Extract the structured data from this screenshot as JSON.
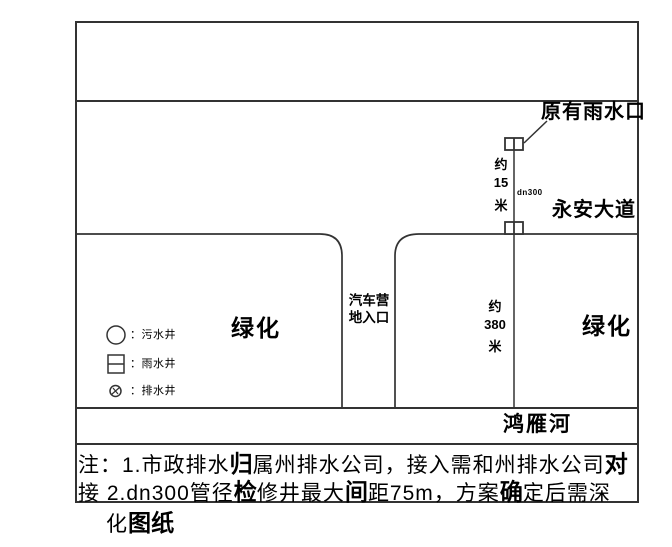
{
  "drawing": {
    "title_labels": {
      "existing_rain_inlet": "原有雨水口",
      "road_name": "永安大道",
      "river_name": "鸿雁河",
      "green_area_left": "绿化",
      "green_area_right": "绿化",
      "entrance_line1": "汽车营",
      "entrance_line2": "地入口",
      "pipe_label": "dn300"
    },
    "dimensions": {
      "dist15": {
        "prefix": "约",
        "value": "15",
        "unit": "米"
      },
      "dist380": {
        "prefix": "约",
        "value": "380",
        "unit": "米"
      }
    },
    "legend": {
      "items": [
        {
          "symbol": "circle",
          "label": "：污水井"
        },
        {
          "symbol": "square",
          "label": "：雨水井"
        },
        {
          "symbol": "hatched-circle",
          "label": "：排水井"
        }
      ]
    },
    "notes": {
      "line1": [
        {
          "t": "注：1.市政排水"
        },
        {
          "t": "归",
          "b": true
        },
        {
          "t": "属州排水公司，接入需和州排水公司"
        },
        {
          "t": "对",
          "b": true
        }
      ],
      "line2": [
        {
          "t": "接 2.dn300管径"
        },
        {
          "t": "检",
          "b": true
        },
        {
          "t": "修井最大"
        },
        {
          "t": "间",
          "b": true
        },
        {
          "t": "距75m，方案"
        },
        {
          "t": "确",
          "b": true
        },
        {
          "t": "定后需深"
        }
      ],
      "line3": [
        {
          "t": "化"
        },
        {
          "t": "图纸",
          "b": true
        }
      ]
    },
    "colors": {
      "line": "#333333",
      "text": "#000000",
      "background": "#ffffff"
    }
  }
}
